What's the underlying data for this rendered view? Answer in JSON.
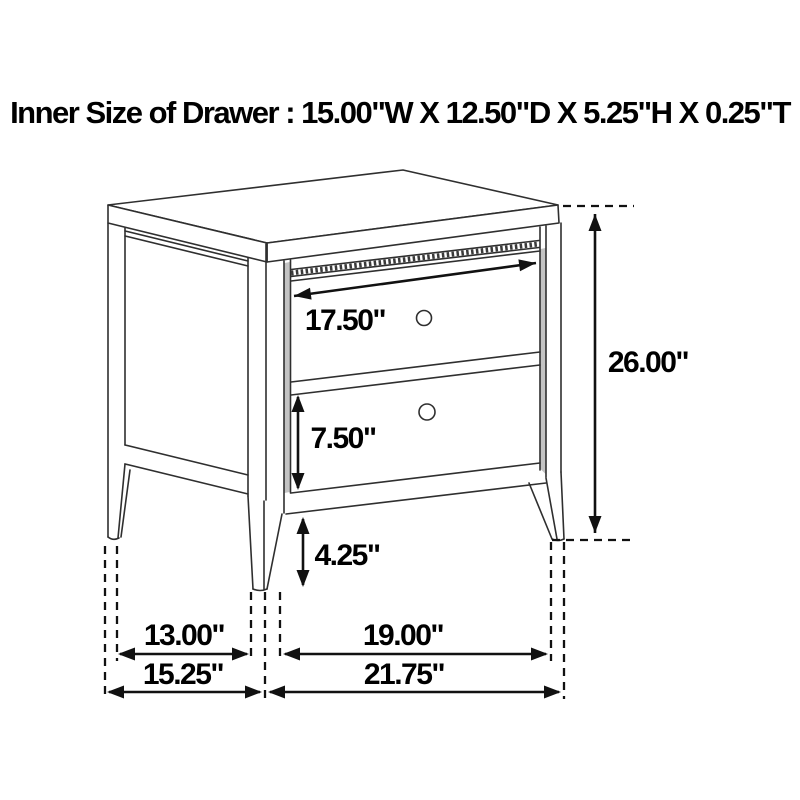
{
  "title": "Inner Size of Drawer : 15.00\"W X 12.50\"D X 5.25\"H X 0.25\"T",
  "dims": {
    "top_drawer_width": "17.50\"",
    "overall_height": "26.00\"",
    "bottom_drawer_height": "7.50\"",
    "leg_height": "4.25\"",
    "inner_depth": "13.00\"",
    "inner_width": "19.00\"",
    "overall_depth": "15.25\"",
    "overall_width": "21.75\""
  },
  "colors": {
    "background": "#ffffff",
    "line_art": "#2f2f2f",
    "dimension_lines": "#111111",
    "label_text": "#000000",
    "opening_shadow": "#c3c3c3"
  }
}
